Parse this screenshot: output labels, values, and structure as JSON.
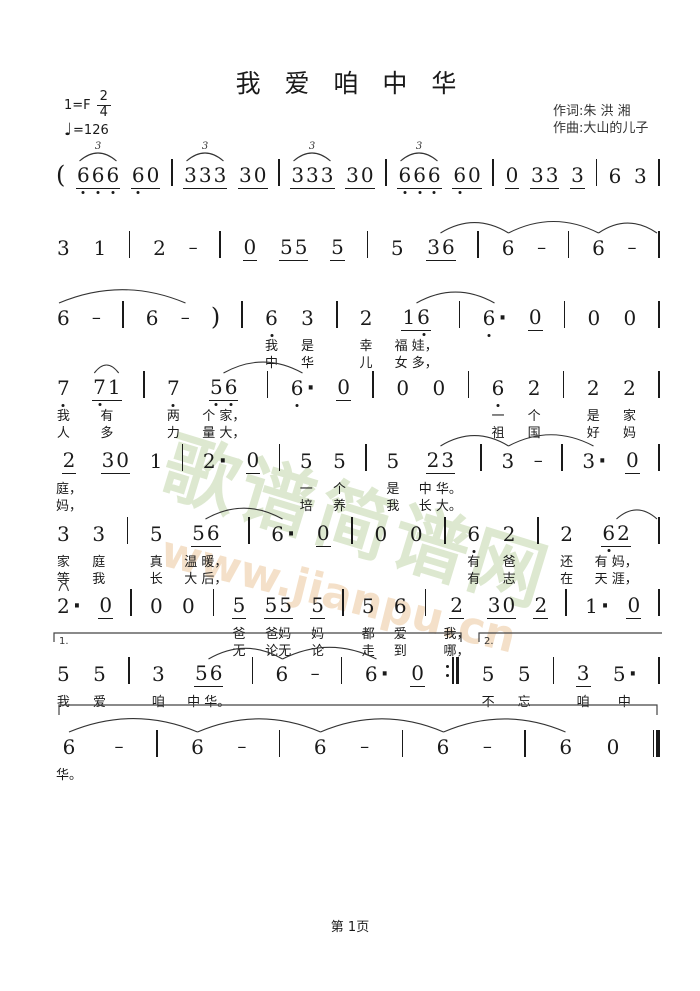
{
  "header": {
    "title": "我 爱 咱 中 华",
    "key": "1=F",
    "time_top": "2",
    "time_bottom": "4",
    "tempo_note": "♩",
    "tempo": "=126",
    "lyricist": "作词:朱 洪 湘",
    "composer": "作曲:大山的儿子"
  },
  "watermark": {
    "cn": "歌谱简谱网",
    "url": "www.jianpu.cn",
    "cn_color": "#bcd3a2",
    "url_color": "#ecc89e"
  },
  "footer": {
    "page": "第 1页"
  },
  "systems": [
    {
      "tokens": [
        {
          "d": "("
        },
        {
          "d": "666",
          "u": 1,
          "ld": [
            1,
            1,
            1
          ]
        },
        {
          "d": "60",
          "u": 1,
          "ld": [
            1,
            0
          ]
        },
        {
          "bar": "s"
        },
        {
          "d": "333",
          "u": 1
        },
        {
          "d": "30",
          "u": 1
        },
        {
          "bar": "s"
        },
        {
          "d": "333",
          "u": 1
        },
        {
          "d": "30",
          "u": 1
        },
        {
          "bar": "s"
        },
        {
          "d": "666",
          "u": 1,
          "ld": [
            1,
            1,
            1
          ]
        },
        {
          "d": "60",
          "u": 1,
          "ld": [
            1,
            0
          ]
        },
        {
          "bar": "s"
        },
        {
          "d": "0",
          "u": 1
        },
        {
          "d": "33",
          "u": 1
        },
        {
          "d": "3",
          "u": 1
        },
        {
          "bar": "s"
        },
        {
          "d": "6"
        },
        {
          "d": "3"
        },
        {
          "bar": "s"
        }
      ],
      "arcs": [
        {
          "a": 1,
          "b": 1,
          "label": "3"
        },
        {
          "a": 4,
          "b": 4,
          "label": "3"
        },
        {
          "a": 7,
          "b": 7,
          "label": "3"
        },
        {
          "a": 10,
          "b": 10,
          "label": "3"
        }
      ]
    },
    {
      "tokens": [
        {
          "d": "3"
        },
        {
          "d": "1"
        },
        {
          "bar": "s"
        },
        {
          "d": "2"
        },
        {
          "dash": true
        },
        {
          "bar": "s"
        },
        {
          "d": "0",
          "u": 1
        },
        {
          "d": "55",
          "u": 1
        },
        {
          "d": "5",
          "u": 1
        },
        {
          "bar": "s"
        },
        {
          "d": "5"
        },
        {
          "d": "36",
          "u": 1
        },
        {
          "bar": "s"
        },
        {
          "d": "6"
        },
        {
          "dash": true
        },
        {
          "bar": "s"
        },
        {
          "d": "6"
        },
        {
          "dash": true
        },
        {
          "bar": "s"
        }
      ],
      "arcs": [
        {
          "a": 11,
          "b": 13
        },
        {
          "a": 13,
          "b": 16
        },
        {
          "a": 16,
          "b": -1
        }
      ]
    },
    {
      "tokens": [
        {
          "d": "6"
        },
        {
          "dash": true
        },
        {
          "bar": "s"
        },
        {
          "d": "6"
        },
        {
          "dash": true
        },
        {
          "d": ")"
        },
        {
          "bar": "s"
        },
        {
          "d": "6",
          "ld": [
            1
          ],
          "l1": "我",
          "l2": "中"
        },
        {
          "d": "3",
          "l1": "是",
          "l2": "华"
        },
        {
          "bar": "s"
        },
        {
          "d": "2",
          "l1": "幸",
          "l2": "儿"
        },
        {
          "d": "16",
          "u": 1,
          "ld": [
            0,
            1
          ],
          "l1": "福 娃，",
          "l2": "女 多，"
        },
        {
          "bar": "s"
        },
        {
          "d": "6",
          "aug": true,
          "ld": [
            1
          ]
        },
        {
          "d": "0",
          "u": 1
        },
        {
          "bar": "s"
        },
        {
          "d": "0"
        },
        {
          "d": "0"
        },
        {
          "bar": "s"
        }
      ],
      "arcs": [
        {
          "a": -1,
          "b": 4
        },
        {
          "a": 11,
          "b": 13
        }
      ]
    },
    {
      "tokens": [
        {
          "d": "7",
          "ld": [
            1
          ],
          "l1": "我",
          "l2": "人"
        },
        {
          "d": "71",
          "u": 1,
          "ld": [
            1,
            0
          ],
          "l1": "有",
          "l2": "多"
        },
        {
          "bar": "s"
        },
        {
          "d": "7",
          "ld": [
            1
          ],
          "l1": "两",
          "l2": "力"
        },
        {
          "d": "56",
          "u": 1,
          "ld": [
            1,
            1
          ],
          "l1": "个 家，",
          "l2": "量 大，"
        },
        {
          "bar": "s"
        },
        {
          "d": "6",
          "aug": true,
          "ld": [
            1
          ]
        },
        {
          "d": "0",
          "u": 1
        },
        {
          "bar": "s"
        },
        {
          "d": "0"
        },
        {
          "d": "0"
        },
        {
          "bar": "s"
        },
        {
          "d": "6",
          "ld": [
            1
          ],
          "l1": "一",
          "l2": "祖"
        },
        {
          "d": "2",
          "l1": "个",
          "l2": "国"
        },
        {
          "bar": "s"
        },
        {
          "d": "2",
          "l1": "是",
          "l2": "好"
        },
        {
          "d": "2",
          "l1": "家",
          "l2": "妈"
        },
        {
          "bar": "s"
        }
      ],
      "arcs": [
        {
          "a": 1,
          "b": 1
        },
        {
          "a": 4,
          "b": 6
        }
      ]
    },
    {
      "tokens": [
        {
          "d": "2",
          "u": 1,
          "l1": "庭，",
          "l2": "妈，"
        },
        {
          "d": "30",
          "u": 1
        },
        {
          "d": "1"
        },
        {
          "bar": "s"
        },
        {
          "d": "2",
          "aug": true
        },
        {
          "d": "0",
          "u": 1
        },
        {
          "bar": "s"
        },
        {
          "d": "5",
          "l1": "一",
          "l2": "培"
        },
        {
          "d": "5",
          "l1": "个",
          "l2": "养"
        },
        {
          "bar": "s"
        },
        {
          "d": "5",
          "l1": "是",
          "l2": "我"
        },
        {
          "d": "23",
          "u": 1,
          "l1": "中 华。",
          "l2": "长 大。"
        },
        {
          "bar": "s"
        },
        {
          "d": "3"
        },
        {
          "dash": true
        },
        {
          "bar": "s"
        },
        {
          "d": "3",
          "aug": true
        },
        {
          "d": "0",
          "u": 1
        },
        {
          "bar": "s"
        }
      ],
      "arcs": [
        {
          "a": 11,
          "b": 13
        },
        {
          "a": 13,
          "b": 16
        }
      ]
    },
    {
      "tokens": [
        {
          "d": "3",
          "l1": "家",
          "l2": "等"
        },
        {
          "d": "3",
          "l1": "庭",
          "l2": "我"
        },
        {
          "bar": "s"
        },
        {
          "d": "5",
          "l1": "真",
          "l2": "长"
        },
        {
          "d": "56",
          "u": 1,
          "l1": "温 暖，",
          "l2": "大 后，"
        },
        {
          "bar": "s"
        },
        {
          "d": "6",
          "aug": true
        },
        {
          "d": "0",
          "u": 1
        },
        {
          "bar": "s"
        },
        {
          "d": "0"
        },
        {
          "d": "0"
        },
        {
          "bar": "s"
        },
        {
          "d": "6",
          "ld": [
            1
          ],
          "l1": "有",
          "l2": "有"
        },
        {
          "d": "2",
          "l1": "爸",
          "l2": "志"
        },
        {
          "bar": "s"
        },
        {
          "d": "2",
          "l1": "还",
          "l2": "在"
        },
        {
          "d": "62",
          "u": 1,
          "ld": [
            1,
            0
          ],
          "l1": "有 妈，",
          "l2": "天 涯，"
        },
        {
          "bar": "s"
        }
      ],
      "arcs": [
        {
          "a": 4,
          "b": 6
        },
        {
          "a": 16,
          "b": -1
        }
      ]
    },
    {
      "tokens": [
        {
          "d": "2",
          "aug": true
        },
        {
          "d": "0",
          "u": 1
        },
        {
          "bar": "s"
        },
        {
          "d": "0"
        },
        {
          "d": "0"
        },
        {
          "bar": "s"
        },
        {
          "d": "5",
          "u": 1,
          "l1": "爸",
          "l2": "无"
        },
        {
          "d": "55",
          "u": 1,
          "l1": "爸妈",
          "l2": "论无"
        },
        {
          "d": "5",
          "u": 1,
          "l1": "妈",
          "l2": "论"
        },
        {
          "bar": "s"
        },
        {
          "d": "5",
          "l1": "都",
          "l2": "走"
        },
        {
          "d": "6",
          "l1": "爱",
          "l2": "到"
        },
        {
          "bar": "s"
        },
        {
          "d": "2",
          "u": 1,
          "l1": "我，",
          "l2": "哪，"
        },
        {
          "d": "30",
          "u": 1
        },
        {
          "d": "2",
          "u": 1
        },
        {
          "bar": "s"
        },
        {
          "d": "1",
          "aug": true
        },
        {
          "d": "0",
          "u": 1
        },
        {
          "bar": "s"
        }
      ],
      "arcs": [
        {
          "a": -1,
          "b": 0
        }
      ]
    },
    {
      "tokens": [
        {
          "d": "5",
          "l1": "我"
        },
        {
          "d": "5",
          "l1": "爱"
        },
        {
          "bar": "s"
        },
        {
          "d": "3",
          "l1": "咱"
        },
        {
          "d": "56",
          "u": 1,
          "l1": "中 华。"
        },
        {
          "bar": "s"
        },
        {
          "d": "6"
        },
        {
          "dash": true
        },
        {
          "bar": "s"
        },
        {
          "d": "6",
          "aug": true
        },
        {
          "d": "0",
          "u": 1
        },
        {
          "bar": "re"
        },
        {
          "d": "5",
          "l1": "不"
        },
        {
          "d": "5",
          "l1": "忘"
        },
        {
          "bar": "s"
        },
        {
          "d": "3",
          "u": 1,
          "l1": "咱"
        },
        {
          "d": "5",
          "aug": true,
          "l1": "中"
        },
        {
          "bar": "s"
        }
      ],
      "arcs": [
        {
          "a": 4,
          "b": 6
        },
        {
          "a": 6,
          "b": 9
        }
      ],
      "voltas": [
        {
          "label": "1.",
          "a": 0,
          "b": 11,
          "tickEnd": true
        },
        {
          "label": "2.",
          "a": 12,
          "b": 17
        }
      ]
    },
    {
      "tokens": [
        {
          "d": "6",
          "l1": "华。"
        },
        {
          "dash": true
        },
        {
          "bar": "s"
        },
        {
          "d": "6"
        },
        {
          "dash": true
        },
        {
          "bar": "s"
        },
        {
          "d": "6"
        },
        {
          "dash": true
        },
        {
          "bar": "s"
        },
        {
          "d": "6"
        },
        {
          "dash": true
        },
        {
          "bar": "s"
        },
        {
          "d": "6"
        },
        {
          "d": "0"
        },
        {
          "bar": "fin"
        }
      ],
      "arcs": [
        {
          "a": 0,
          "b": 3
        },
        {
          "a": 3,
          "b": 6
        },
        {
          "a": 6,
          "b": 9
        },
        {
          "a": 9,
          "b": 12
        }
      ],
      "bracket": true
    }
  ]
}
